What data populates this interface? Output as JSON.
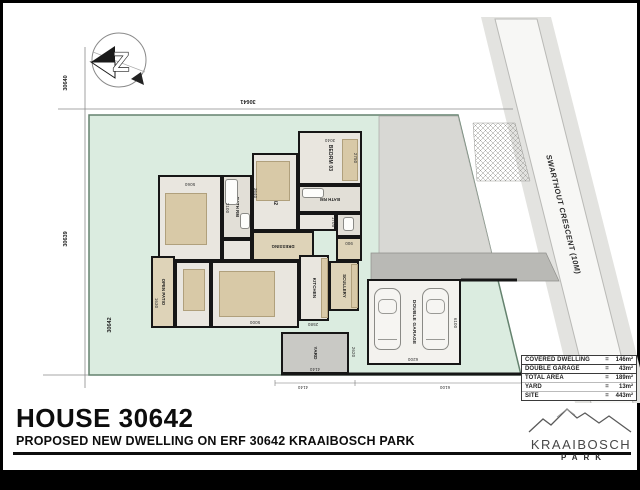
{
  "page": {
    "title": "HOUSE 30642",
    "subtitle": "PROPOSED NEW DWELLING ON ERF 30642 KRAAIBOSCH PARK"
  },
  "north": {
    "letter": "Z"
  },
  "site": {
    "street_label": "SWARTHOUT CRESCENT (10M)",
    "erf_top_left": "30640",
    "erf_left": "30639",
    "erf_top": "30641",
    "erf_site": "30642"
  },
  "area_table": {
    "rows": [
      {
        "label": "COVERED DWELLING",
        "eq": "=",
        "value": "146m²"
      },
      {
        "label": "DOUBLE GARAGE",
        "eq": "=",
        "value": "43m²"
      },
      {
        "label": "TOTAL AREA",
        "eq": "=",
        "value": "189m²"
      },
      {
        "label": "YARD",
        "eq": "=",
        "value": "13m²"
      },
      {
        "label": "SITE",
        "eq": "=",
        "value": "443m²"
      }
    ]
  },
  "logo": {
    "name": "KRAAIBOSCH",
    "sub": "PARK"
  },
  "colors": {
    "site_green": "#dbece0",
    "paving": "#d8d8d4",
    "driveway": "#b9b9b5",
    "wall": "#161616",
    "floor": "#e9e6df",
    "tan": "#d8c9a7"
  },
  "plan": {
    "rooms": [
      {
        "name": "room-main-bedrm",
        "label": "MAIN BEDRM",
        "x": 155,
        "y": 172,
        "w": 64,
        "h": 86,
        "rot": 90,
        "fs": 5,
        "fill": "#e9e6df"
      },
      {
        "name": "room-bath-1",
        "label": "BATH RM",
        "x": 219,
        "y": 172,
        "w": 30,
        "h": 64,
        "rot": 90,
        "fs": 4.2,
        "fill": "#e2dfd7"
      },
      {
        "name": "room-hall-1",
        "label": "",
        "x": 219,
        "y": 236,
        "w": 30,
        "h": 22,
        "fill": "#e9e6df"
      },
      {
        "name": "room-bedrm-02",
        "label": "BEDRM 02",
        "x": 249,
        "y": 150,
        "w": 46,
        "h": 78,
        "rot": 90,
        "fs": 5,
        "fill": "#e9e6df"
      },
      {
        "name": "room-bedrm-03",
        "label": "BEDRM 03",
        "x": 295,
        "y": 128,
        "w": 64,
        "h": 54,
        "rot": 90,
        "fs": 5,
        "fill": "#e9e6df"
      },
      {
        "name": "room-bath-2",
        "label": "BATH RM",
        "x": 295,
        "y": 182,
        "w": 64,
        "h": 28,
        "rot": 180,
        "fs": 4.2,
        "fill": "#e2dfd7"
      },
      {
        "name": "room-corridor",
        "label": "",
        "x": 295,
        "y": 210,
        "w": 38,
        "h": 18,
        "fill": "#e9e6df"
      },
      {
        "name": "room-wc",
        "label": "",
        "x": 333,
        "y": 210,
        "w": 26,
        "h": 24,
        "fill": "#e2dfd7"
      },
      {
        "name": "room-dressing",
        "label": "DRESSING",
        "x": 249,
        "y": 228,
        "w": 62,
        "h": 30,
        "rot": 180,
        "fs": 4.2,
        "fill": "#ded3b8"
      },
      {
        "name": "room-entrance",
        "label": "",
        "x": 333,
        "y": 234,
        "w": 26,
        "h": 24,
        "fill": "#ded3b8"
      },
      {
        "name": "room-open-patio",
        "label": "OPEN PATIO",
        "x": 148,
        "y": 253,
        "w": 24,
        "h": 72,
        "rot": 90,
        "fs": 4.2,
        "fill": "#ded3b8"
      },
      {
        "name": "room-dining",
        "label": "DINING",
        "x": 172,
        "y": 258,
        "w": 36,
        "h": 67,
        "rot": 90,
        "fs": 5,
        "fill": "#e9e6df"
      },
      {
        "name": "room-lounge",
        "label": "LOUNGE",
        "x": 208,
        "y": 258,
        "w": 88,
        "h": 67,
        "rot": 90,
        "fs": 5,
        "fill": "#e9e6df"
      },
      {
        "name": "room-kitchen",
        "label": "KITCHEN",
        "x": 296,
        "y": 252,
        "w": 30,
        "h": 66,
        "rot": 90,
        "fs": 4.4,
        "fill": "#e9e6df"
      },
      {
        "name": "room-scullery",
        "label": "SCULLERY",
        "x": 326,
        "y": 258,
        "w": 30,
        "h": 50,
        "rot": 90,
        "fs": 4.2,
        "fill": "#ded3b8"
      },
      {
        "name": "room-yard",
        "label": "YARD",
        "x": 278,
        "y": 329,
        "w": 68,
        "h": 42,
        "rot": 90,
        "fs": 4.6,
        "fill": "#c9c9c5"
      },
      {
        "name": "room-double-garage",
        "label": "DOUBLE GARAGE",
        "x": 364,
        "y": 276,
        "w": 94,
        "h": 86,
        "rot": 90,
        "fs": 4.8,
        "fill": "#f3f2ee"
      }
    ],
    "furniture": [
      {
        "type": "tan",
        "x": 162,
        "y": 190,
        "w": 42,
        "h": 52
      },
      {
        "type": "tan",
        "x": 253,
        "y": 158,
        "w": 34,
        "h": 40
      },
      {
        "type": "tan",
        "x": 339,
        "y": 136,
        "w": 16,
        "h": 42
      },
      {
        "type": "tan",
        "x": 216,
        "y": 268,
        "w": 56,
        "h": 46
      },
      {
        "type": "tan",
        "x": 180,
        "y": 266,
        "w": 22,
        "h": 42
      },
      {
        "type": "tan",
        "x": 318,
        "y": 255,
        "w": 7,
        "h": 60
      },
      {
        "type": "tan",
        "x": 348,
        "y": 261,
        "w": 7,
        "h": 44
      },
      {
        "type": "fixture",
        "x": 222,
        "y": 176,
        "w": 13,
        "h": 26
      },
      {
        "type": "fixture",
        "x": 237,
        "y": 210,
        "w": 10,
        "h": 16
      },
      {
        "type": "fixture",
        "x": 299,
        "y": 185,
        "w": 22,
        "h": 10
      },
      {
        "type": "fixture",
        "x": 340,
        "y": 214,
        "w": 11,
        "h": 14
      },
      {
        "type": "car",
        "x": 371,
        "y": 285,
        "w": 27,
        "h": 62
      },
      {
        "type": "car",
        "x": 419,
        "y": 285,
        "w": 27,
        "h": 62
      }
    ],
    "dimensions": [
      {
        "text": "5060",
        "x": 187,
        "y": 181,
        "rot": 180,
        "fs": 4.4
      },
      {
        "text": "3040",
        "x": 327,
        "y": 137,
        "rot": 180,
        "fs": 4.4
      },
      {
        "text": "2750",
        "x": 352,
        "y": 155,
        "rot": 90,
        "fs": 4.4
      },
      {
        "text": "3640",
        "x": 252,
        "y": 190,
        "rot": 90,
        "fs": 4.4
      },
      {
        "text": "2100",
        "x": 224,
        "y": 205,
        "rot": 90,
        "fs": 4.4
      },
      {
        "text": "900",
        "x": 346,
        "y": 240,
        "rot": 180,
        "fs": 4.4
      },
      {
        "text": "1705",
        "x": 330,
        "y": 219,
        "rot": 90,
        "fs": 4.4
      },
      {
        "text": "5000",
        "x": 252,
        "y": 319,
        "rot": 180,
        "fs": 4.4
      },
      {
        "text": "2580",
        "x": 310,
        "y": 321,
        "rot": 180,
        "fs": 4.4
      },
      {
        "text": "1630",
        "x": 153,
        "y": 300,
        "rot": 90,
        "fs": 4.4
      },
      {
        "text": "6100",
        "x": 452,
        "y": 320,
        "rot": 90,
        "fs": 4.4
      },
      {
        "text": "6200",
        "x": 410,
        "y": 356,
        "rot": 180,
        "fs": 4.4
      },
      {
        "text": "4140",
        "x": 312,
        "y": 366,
        "rot": 180,
        "fs": 4.4
      },
      {
        "text": "2620",
        "x": 350,
        "y": 349,
        "rot": 90,
        "fs": 4.4
      },
      {
        "text": "4140",
        "x": 300,
        "y": 384,
        "rot": 180,
        "fs": 4.4
      },
      {
        "text": "6100",
        "x": 442,
        "y": 384,
        "rot": 180,
        "fs": 4.4
      }
    ]
  }
}
